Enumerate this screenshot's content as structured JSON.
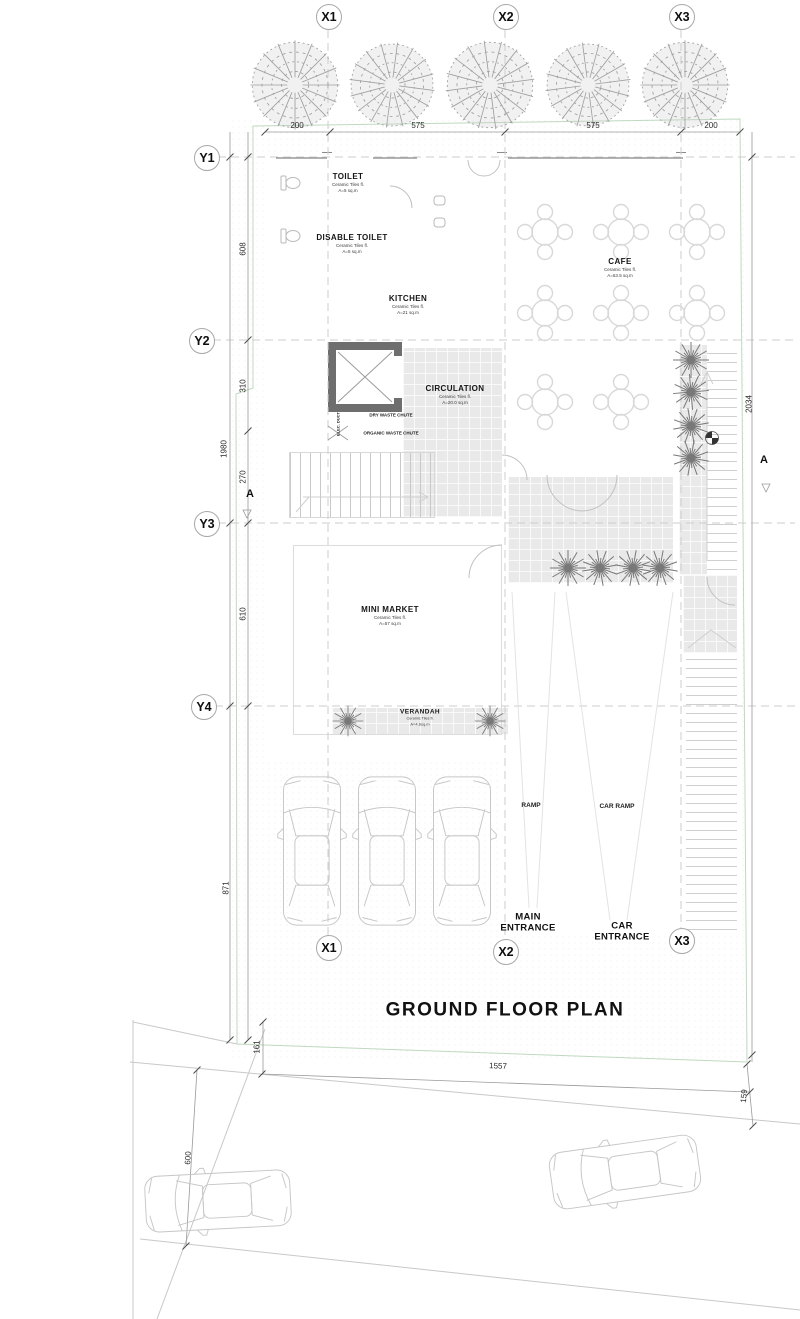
{
  "title": "GROUND FLOOR PLAN",
  "grid": {
    "x": [
      "X1",
      "X2",
      "X3"
    ],
    "y": [
      "Y1",
      "Y2",
      "Y3",
      "Y4"
    ],
    "section": "A"
  },
  "dims": {
    "top": [
      "200",
      "575",
      "575",
      "200"
    ],
    "left": [
      "608",
      "310",
      "270",
      "1980",
      "610",
      "871"
    ],
    "right": [
      "2034"
    ],
    "bottom": [
      "1557",
      "161",
      "159",
      "600"
    ]
  },
  "rooms": {
    "toilet": {
      "name": "TOILET",
      "finish": "Ceramic Tiles fl.",
      "area": "A=5 sq.m"
    },
    "disable_toilet": {
      "name": "DISABLE TOILET",
      "finish": "Ceramic Tiles fl.",
      "area": "A=5 sq.m"
    },
    "kitchen": {
      "name": "KITCHEN",
      "finish": "Ceramic Tiles fl.",
      "area": "A=21 sq.m"
    },
    "cafe": {
      "name": "CAFE",
      "finish": "Ceramic Tiles fl.",
      "area": "A=63.5 sq.m"
    },
    "circulation": {
      "name": "CIRCULATION",
      "finish": "Ceramic Tiles fl.",
      "area": "A=20.0 sq.m"
    },
    "mini_market": {
      "name": "MINI MARKET",
      "finish": "Ceramic Tiles fl.",
      "area": "A=57 sq.m"
    },
    "verandah": {
      "name": "VERANDAH",
      "finish": "Ceramic Tiles fl.",
      "area": "A=4.6sq.m"
    }
  },
  "service": {
    "elec_duct": "ELEC. DUCT",
    "dry_waste": "DRY WASTE CHUTE",
    "organic_waste": "ORGANIC WASTE CHUTE"
  },
  "labels": {
    "ramp": "RAMP",
    "car_ramp": "CAR RAMP",
    "main_entrance": "MAIN ENTRANCE",
    "car_entrance": "CAR ENTRANCE"
  },
  "colors": {
    "wall": "#161616",
    "column": "#8a8a8a",
    "tile": "#e9e9e9",
    "boundary": "#bfd9bf",
    "plant": "#777777"
  }
}
